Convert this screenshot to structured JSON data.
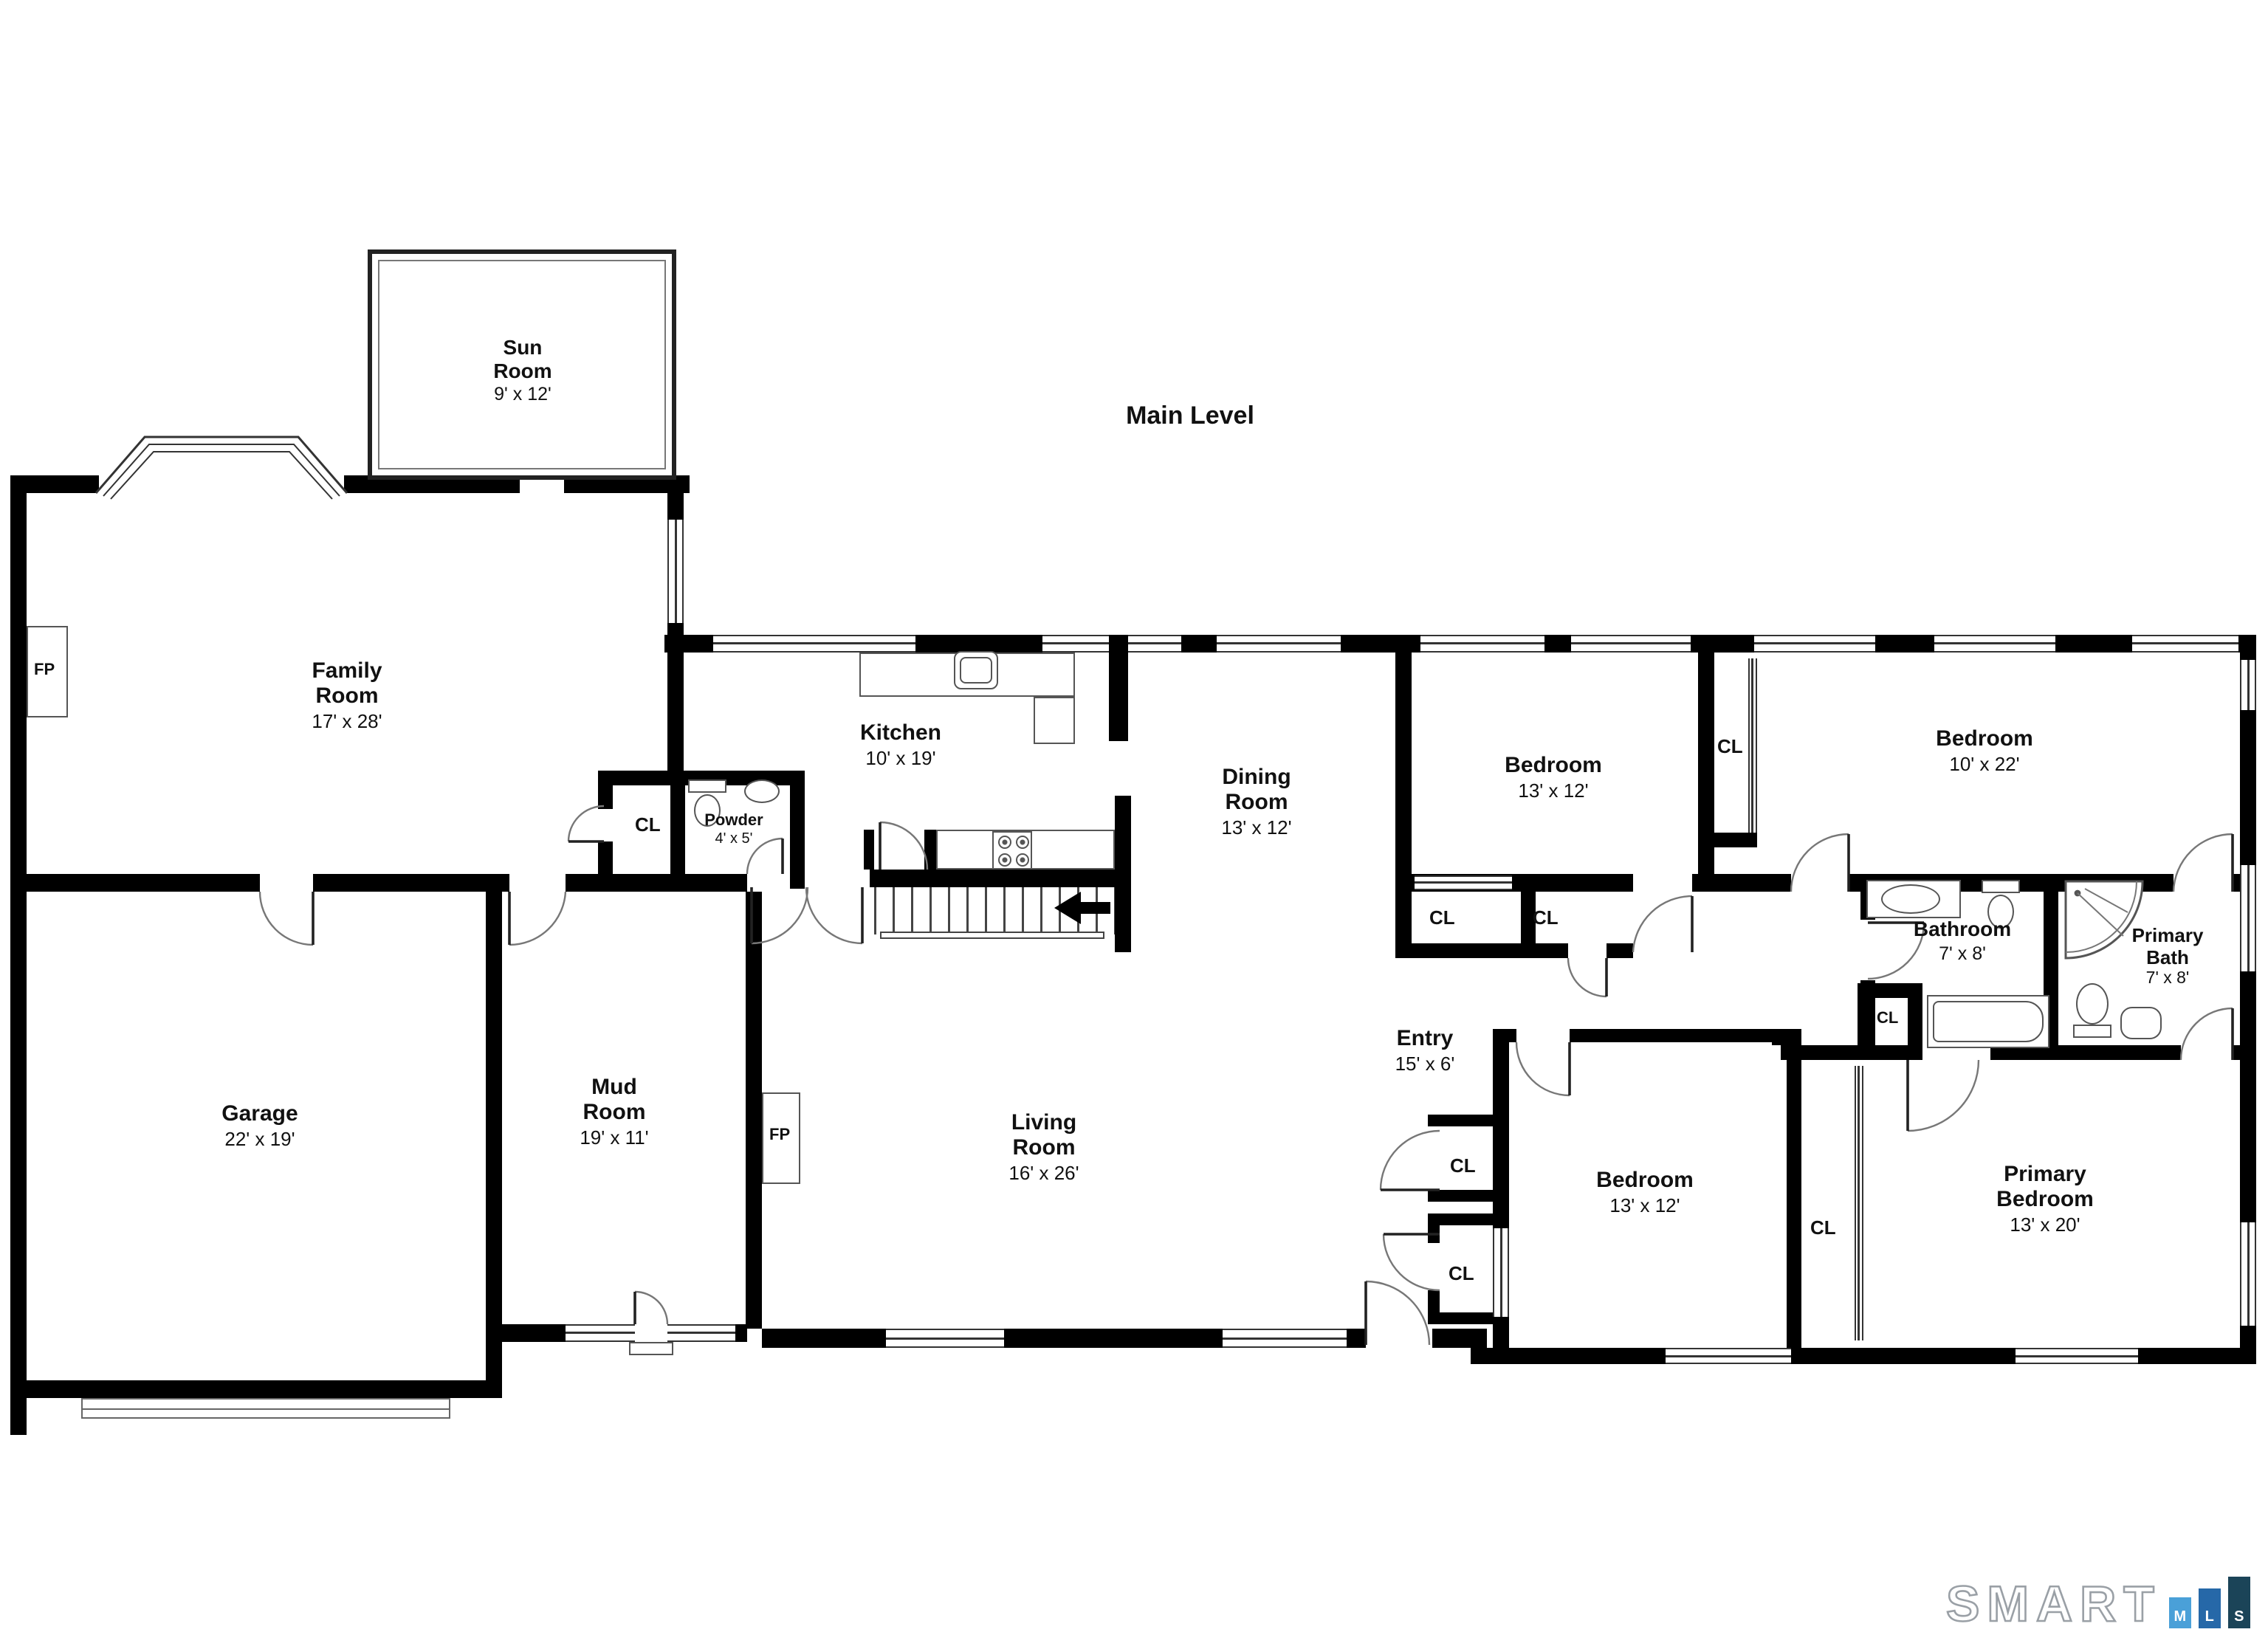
{
  "title": "Main Level",
  "fireplace_label": "FP",
  "closet_label": "CL",
  "rooms": [
    {
      "id": "sun-room",
      "name": "Sun Room",
      "dims": "9' x 12'"
    },
    {
      "id": "family-room",
      "name": "Family Room",
      "dims": "17' x 28'"
    },
    {
      "id": "kitchen",
      "name": "Kitchen",
      "dims": "10' x 19'"
    },
    {
      "id": "powder",
      "name": "Powder",
      "dims": "4' x 5'"
    },
    {
      "id": "dining-room",
      "name": "Dining Room",
      "dims": "13' x 12'"
    },
    {
      "id": "bedroom-top",
      "name": "Bedroom",
      "dims": "13' x 12'"
    },
    {
      "id": "bedroom-right",
      "name": "Bedroom",
      "dims": "10' x 22'"
    },
    {
      "id": "bathroom",
      "name": "Bathroom",
      "dims": "7' x 8'"
    },
    {
      "id": "primary-bath",
      "name": "Primary Bath",
      "dims": "7' x 8'"
    },
    {
      "id": "entry",
      "name": "Entry",
      "dims": "15' x 6'"
    },
    {
      "id": "garage",
      "name": "Garage",
      "dims": "22' x 19'"
    },
    {
      "id": "mud-room",
      "name": "Mud Room",
      "dims": "19' x 11'"
    },
    {
      "id": "living-room",
      "name": "Living Room",
      "dims": "16' x 26'"
    },
    {
      "id": "bedroom-bottom",
      "name": "Bedroom",
      "dims": "13' x 12'"
    },
    {
      "id": "primary-bedroom",
      "name": "Primary Bedroom",
      "dims": "13' x 20'"
    }
  ],
  "colors": {
    "wall": "#000000",
    "fixture_line": "#555555"
  },
  "logo": {
    "text": "SMART",
    "bars": [
      {
        "letter": "M",
        "color": "#4AA0D8",
        "height": 21
      },
      {
        "letter": "L",
        "color": "#2668A8",
        "height": 27
      },
      {
        "letter": "S",
        "color": "#1B4458",
        "height": 35
      }
    ]
  }
}
